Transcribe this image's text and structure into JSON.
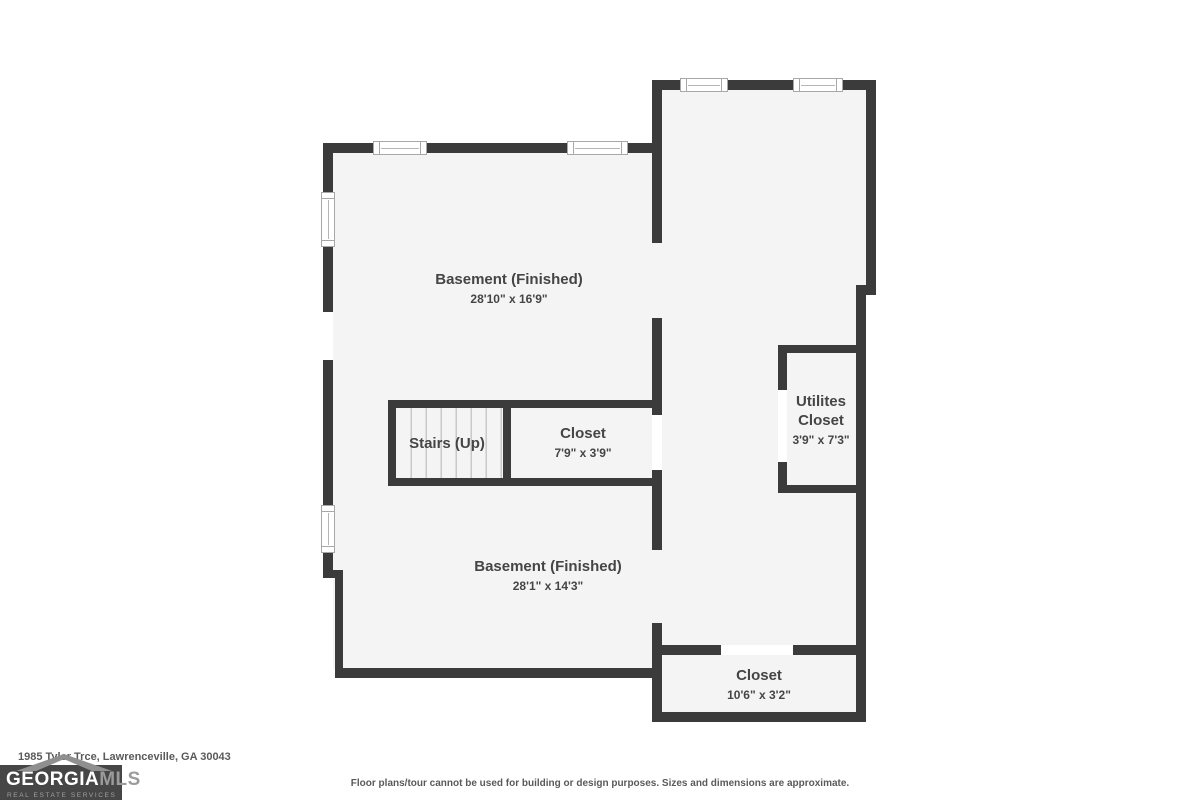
{
  "floor_plan": {
    "rooms": {
      "basement_upper": {
        "name": "Basement (Finished)",
        "dims": "28'10\" x 16'9\""
      },
      "stairs": {
        "name": "Stairs (Up)"
      },
      "closet_mid": {
        "name": "Closet",
        "dims": "7'9\" x 3'9\""
      },
      "utilities_closet": {
        "name": "Utilites Closet",
        "dims": "3'9\" x 7'3\""
      },
      "basement_lower": {
        "name": "Basement (Finished)",
        "dims": "28'1\" x 14'3\""
      },
      "closet_bottom": {
        "name": "Closet",
        "dims": "10'6\" x 3'2\""
      }
    }
  },
  "footer": {
    "address": "1985 Tyler Trce, Lawrenceville, GA 30043",
    "disclaimer": "Floor plans/tour cannot be used for building or design purposes. Sizes and dimensions are approximate.",
    "logo": {
      "brand_primary": "GEORGIA",
      "brand_secondary": "MLS",
      "tagline": "REAL ESTATE SERVICES"
    }
  },
  "colors": {
    "wall": "#3b3b3b",
    "room_fill": "#f4f4f4",
    "label_text": "#454545",
    "logo_background": "#464646",
    "logo_gray": "#9b9b9b",
    "page_background": "#ffffff"
  }
}
